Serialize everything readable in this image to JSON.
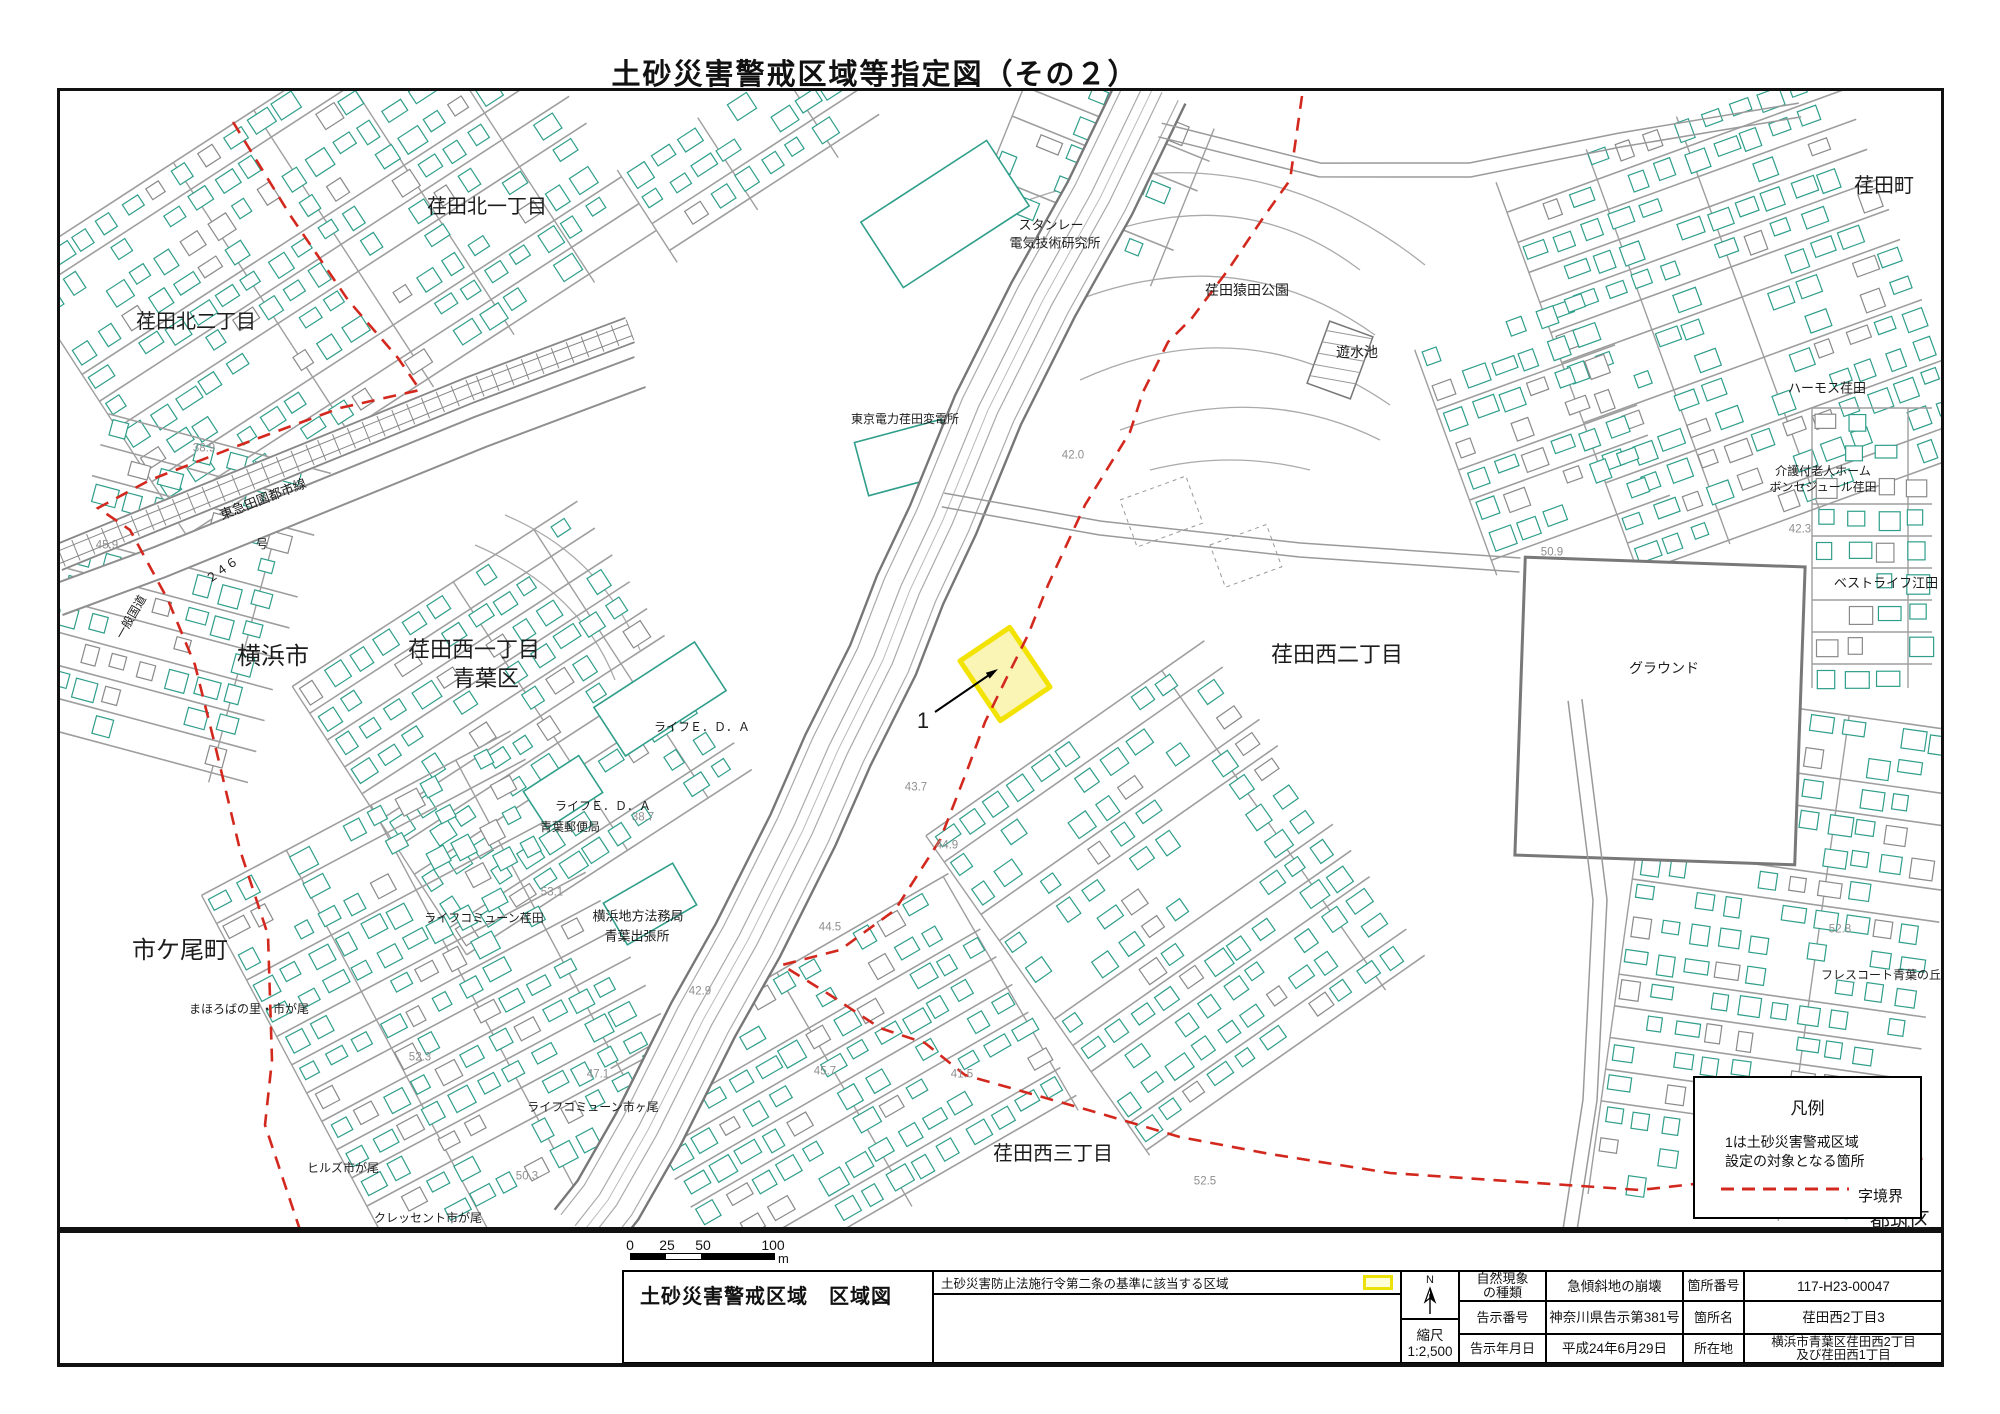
{
  "page_title": "土砂災害警戒区域等指定図（その２）",
  "north_label": "N",
  "scale_bar": {
    "ticks": [
      "0",
      "25",
      "50",
      "100"
    ],
    "unit": "m"
  },
  "legend": {
    "title": "凡例",
    "note_line1": "1は土砂災害警戒区域",
    "note_line2": "設定の対象となる箇所",
    "boundary_label": "字境界",
    "boundary_color": "#d3281e"
  },
  "title_block": {
    "sheet_name": "土砂災害警戒区域　区域図",
    "criteria_text": "土砂災害防止法施行令第二条の基準に該当する区域",
    "scale_label": "縮尺",
    "scale_value": "1:2,500",
    "fields": {
      "phenomenon_label": "自然現象\nの種類",
      "phenomenon_value": "急傾斜地の崩壊",
      "notice_no_label": "告示番号",
      "notice_no_value": "神奈川県告示第381号",
      "notice_date_label": "告示年月日",
      "notice_date_value": "平成24年6月29日",
      "site_no_label": "箇所番号",
      "site_no_value": "117-H23-00047",
      "site_name_label": "箇所名",
      "site_name_value": "荏田西2丁目3",
      "location_label": "所在地",
      "location_value": "横浜市青葉区荏田西2丁目\n及び荏田西1丁目"
    }
  },
  "map": {
    "site_marker": "1",
    "colors": {
      "building": "#2f9e8a",
      "road": "#8f8f8f",
      "boundary": "#d3281e",
      "highlight_fill": "#faf3ad",
      "highlight_stroke": "#f2e305"
    },
    "area_labels": [
      {
        "text": "荏田北一丁目",
        "x": 487,
        "y": 207,
        "fs": 20
      },
      {
        "text": "荏田町",
        "x": 1884,
        "y": 186,
        "fs": 20
      },
      {
        "text": "荏田北二丁目",
        "x": 196,
        "y": 322,
        "fs": 20
      },
      {
        "text": "スタンレー",
        "x": 1051,
        "y": 225,
        "fs": 13
      },
      {
        "text": "電気技術研究所",
        "x": 1055,
        "y": 243,
        "fs": 13
      },
      {
        "text": "荏田猿田公園",
        "x": 1247,
        "y": 290,
        "fs": 14
      },
      {
        "text": "遊水池",
        "x": 1357,
        "y": 352,
        "fs": 14
      },
      {
        "text": "東京電力荏田変電所",
        "x": 905,
        "y": 419,
        "fs": 12
      },
      {
        "text": "ハーモス荏田",
        "x": 1827,
        "y": 388,
        "fs": 13
      },
      {
        "text": "介護付老人ホーム",
        "x": 1823,
        "y": 471,
        "fs": 12
      },
      {
        "text": "ボンセジュール荏田",
        "x": 1823,
        "y": 487,
        "fs": 12
      },
      {
        "text": "ベストライフ江田",
        "x": 1886,
        "y": 583,
        "fs": 13
      },
      {
        "text": "横浜市",
        "x": 273,
        "y": 657,
        "fs": 24
      },
      {
        "text": "荏田西一丁目",
        "x": 474,
        "y": 650,
        "fs": 22
      },
      {
        "text": "青葉区",
        "x": 486,
        "y": 679,
        "fs": 22
      },
      {
        "text": "荏田西二丁目",
        "x": 1337,
        "y": 655,
        "fs": 22
      },
      {
        "text": "グラウンド",
        "x": 1664,
        "y": 668,
        "fs": 14
      },
      {
        "text": "ライフＥ．Ｄ．Ａ",
        "x": 702,
        "y": 727,
        "fs": 12
      },
      {
        "text": "ライフＥ．Ｄ．Ａ",
        "x": 603,
        "y": 806,
        "fs": 12
      },
      {
        "text": "青葉郵便局",
        "x": 570,
        "y": 827,
        "fs": 12
      },
      {
        "text": "市ケ尾町",
        "x": 180,
        "y": 951,
        "fs": 24
      },
      {
        "text": "ライフコミューン荏田",
        "x": 484,
        "y": 918,
        "fs": 12
      },
      {
        "text": "横浜地方法務局",
        "x": 638,
        "y": 916,
        "fs": 13
      },
      {
        "text": "青葉出張所",
        "x": 637,
        "y": 936,
        "fs": 13
      },
      {
        "text": "まほろばの里・市が尾",
        "x": 249,
        "y": 1009,
        "fs": 12
      },
      {
        "text": "ライフコミューン市ヶ尾",
        "x": 593,
        "y": 1107,
        "fs": 12
      },
      {
        "text": "ヒルズ市が尾",
        "x": 343,
        "y": 1168,
        "fs": 12
      },
      {
        "text": "クレッセント市が尾",
        "x": 428,
        "y": 1218,
        "fs": 12
      },
      {
        "text": "フレスコート青葉の丘",
        "x": 1881,
        "y": 975,
        "fs": 12
      },
      {
        "text": "荏田西三丁目",
        "x": 1053,
        "y": 1154,
        "fs": 20
      },
      {
        "text": "都筑区",
        "x": 1900,
        "y": 1221,
        "fs": 20
      },
      {
        "text": "東急田園都市線",
        "x": 263,
        "y": 499,
        "fs": 13,
        "rot": -21
      },
      {
        "text": "一般国道",
        "x": 131,
        "y": 617,
        "fs": 12,
        "rot": -60
      },
      {
        "text": "２４６",
        "x": 222,
        "y": 570,
        "fs": 12,
        "rot": -35
      },
      {
        "text": "号",
        "x": 262,
        "y": 544,
        "fs": 12
      },
      {
        "text": "1",
        "x": 923,
        "y": 721,
        "fs": 22
      }
    ],
    "elevation_labels": [
      {
        "v": "38.9",
        "x": 204,
        "y": 449
      },
      {
        "v": "45.9",
        "x": 107,
        "y": 546
      },
      {
        "v": "42.0",
        "x": 1073,
        "y": 456
      },
      {
        "v": "43.7",
        "x": 916,
        "y": 788
      },
      {
        "v": "44.9",
        "x": 947,
        "y": 846
      },
      {
        "v": "38.7",
        "x": 643,
        "y": 818
      },
      {
        "v": "44.5",
        "x": 830,
        "y": 928
      },
      {
        "v": "53.1",
        "x": 552,
        "y": 893
      },
      {
        "v": "42.9",
        "x": 700,
        "y": 992
      },
      {
        "v": "47.1",
        "x": 598,
        "y": 1075
      },
      {
        "v": "52.3",
        "x": 420,
        "y": 1058
      },
      {
        "v": "45.7",
        "x": 825,
        "y": 1072
      },
      {
        "v": "41.5",
        "x": 962,
        "y": 1075
      },
      {
        "v": "50.3",
        "x": 527,
        "y": 1177
      },
      {
        "v": "52.5",
        "x": 1205,
        "y": 1182
      },
      {
        "v": "50.9",
        "x": 1552,
        "y": 553
      },
      {
        "v": "42.3",
        "x": 1800,
        "y": 530
      },
      {
        "v": "52.8",
        "x": 1840,
        "y": 930
      }
    ]
  }
}
